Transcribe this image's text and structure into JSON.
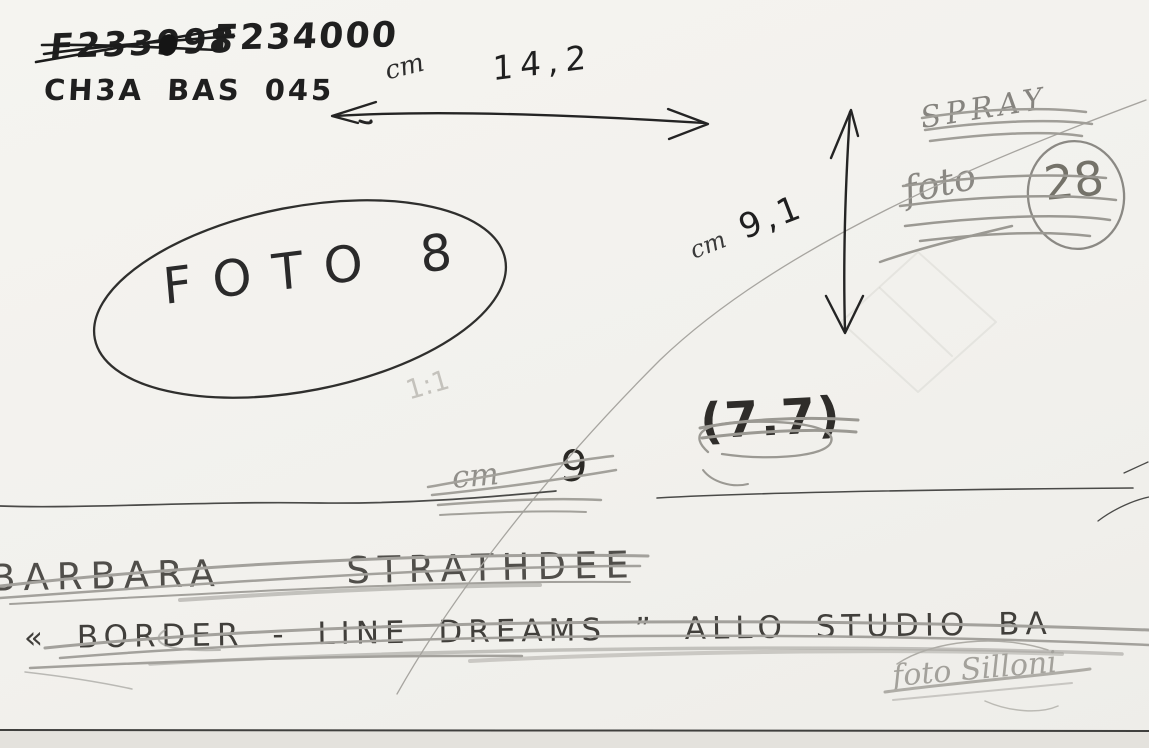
{
  "colors": {
    "paper": "#f2f1ed",
    "ink": "#1f1f1f",
    "pencil": "#8a8883",
    "pencil_dark": "#4e4c49",
    "faint_pencil": "#c4c2bc"
  },
  "header": {
    "old_number": "F233998",
    "new_number": "F234000",
    "catalog_code": "CH3A BAS 045"
  },
  "dimensions": {
    "width_unit": "cm",
    "width_value": "14,2",
    "height_unit": "cm",
    "height_value": "9,1",
    "crossed_unit": "cm",
    "crossed_value": "9",
    "crossed_ratio": "(7.7)",
    "scale": "1:1"
  },
  "photo_labels": {
    "spray": "SPRAY",
    "foto_small": "foto",
    "foto_small_number": "28",
    "foto_main": "FOTO 8"
  },
  "caption": {
    "artist": "BARBARA STRATHDEE",
    "title": "« BORDER - LINE DREAMS ” ALLO STUDIO BA",
    "credit": "foto Silloni"
  }
}
